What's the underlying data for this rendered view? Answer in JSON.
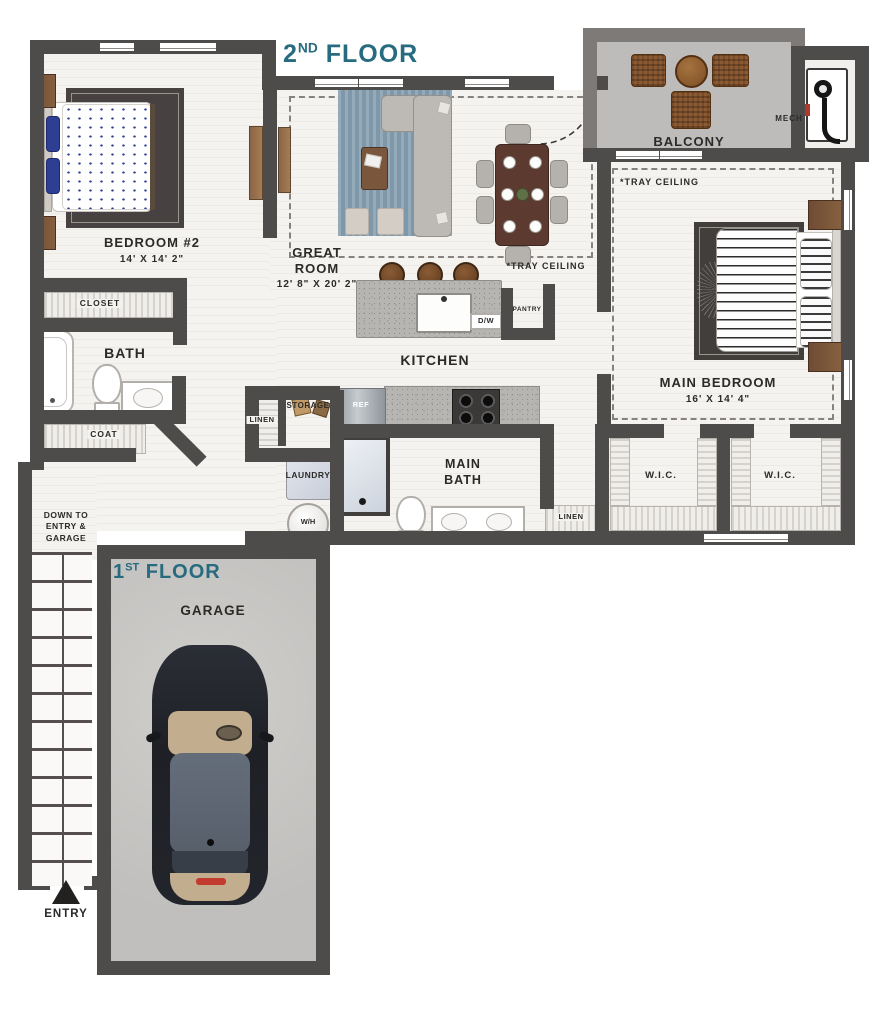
{
  "titles": {
    "floor2_num": "2",
    "floor2_sup": "ND",
    "floor2_word": " FLOOR",
    "floor1_num": "1",
    "floor1_sup": "ST",
    "floor1_word": " FLOOR"
  },
  "rooms": {
    "bedroom2_name": "BEDROOM #2",
    "bedroom2_dims": "14' X 14' 2\"",
    "great_room_line1": "GREAT",
    "great_room_line2": "ROOM",
    "great_room_dims": "12' 8\" X 20' 2\"",
    "main_bedroom_name": "MAIN BEDROOM",
    "main_bedroom_dims": "16' X 14' 4\"",
    "kitchen": "KITCHEN",
    "main_bath_line1": "MAIN",
    "main_bath_line2": "BATH",
    "bath": "BATH",
    "balcony": "BALCONY",
    "garage": "GARAGE"
  },
  "labels": {
    "closet": "CLOSET",
    "coat": "COAT",
    "linen": "LINEN",
    "storage": "STORAGE",
    "laundry": "LAUNDRY",
    "water_heater": "W/H",
    "ref": "REF",
    "dishwasher": "D/W",
    "pantry": "PANTRY",
    "mech": "MECH",
    "wic": "W.I.C.",
    "tray_ceiling": "*TRAY CEILING",
    "down_to": "DOWN TO ENTRY & GARAGE",
    "entry": "ENTRY"
  },
  "colors": {
    "wall": "#4e4b4b",
    "balcony_wall": "#7d7a78",
    "floor_title_teal": "#266b7f",
    "label_text": "#2b2a28",
    "great_room_rug": "#7e98a9",
    "bedroom_rug": "#474241",
    "concrete": "#c6c5c3"
  }
}
